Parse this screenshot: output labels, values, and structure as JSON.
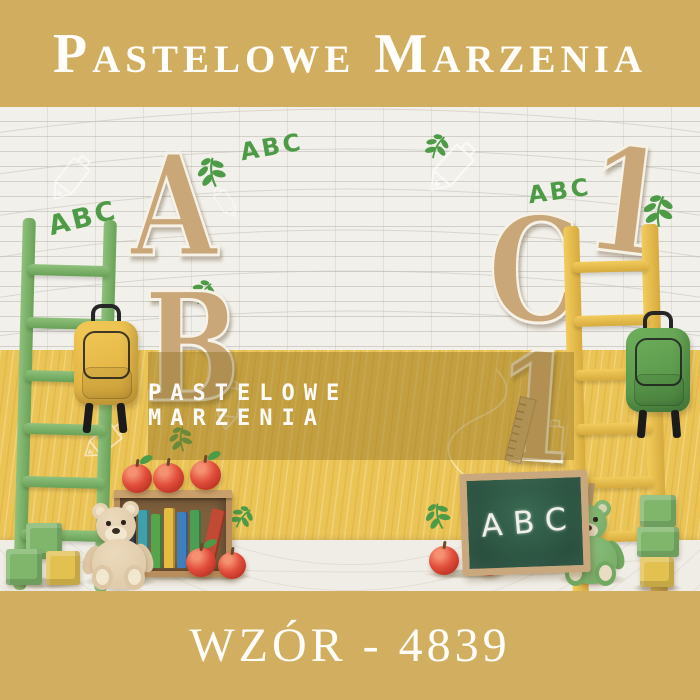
{
  "header": {
    "brand": "Pastelowe Marzenia",
    "bg_color": "#D1AD5F",
    "text_color": "#FFFEFA"
  },
  "watermark": {
    "text": "PASTELOWE MARZENIA",
    "band_color": "rgba(146,115,38,0.45)",
    "text_color": "#FFFFFF"
  },
  "footer": {
    "pattern_label": "WZÓR - 4839",
    "bg_color": "#D2AE60",
    "text_color": "#FFFEFA"
  },
  "scene": {
    "letters": [
      {
        "char": "A"
      },
      {
        "char": "B"
      },
      {
        "char": "C"
      },
      {
        "char": "1"
      },
      {
        "char": "1"
      }
    ],
    "graffiti": [
      {
        "text": "ABC"
      },
      {
        "text": "ABC"
      },
      {
        "text": "ABC"
      }
    ],
    "chalkboard": {
      "text": "ABC",
      "board_color": "#2E553F",
      "frame_color": "#C9A87D"
    },
    "palette": {
      "wall_white": "#F2F0EB",
      "wall_yellow": "#EBC456",
      "floor": "#F0EDE6",
      "ladder_left_green": "#7DB369",
      "ladder_right_yellow": "#EDC74F",
      "backpack_left_yellow": "#EEC14E",
      "backpack_right_green": "#63A651",
      "wood_letter": "#C9A778",
      "apple_red": "#C23A2B",
      "leaf_green": "#4E9B47",
      "teddy_left_beige": "#DCC6A4",
      "teddy_right_green": "#71A963",
      "crate_wood": "#B98E5C",
      "block_green": "#7FB66B",
      "block_yellow": "#E2C150",
      "chalk_white": "#FFFFFF"
    },
    "book_spine_colors": [
      "#2E3E4E",
      "#3FA0AC",
      "#56A44C",
      "#E3BC41",
      "#3F7FBC",
      "#4C9E55",
      "#C24A35"
    ]
  }
}
